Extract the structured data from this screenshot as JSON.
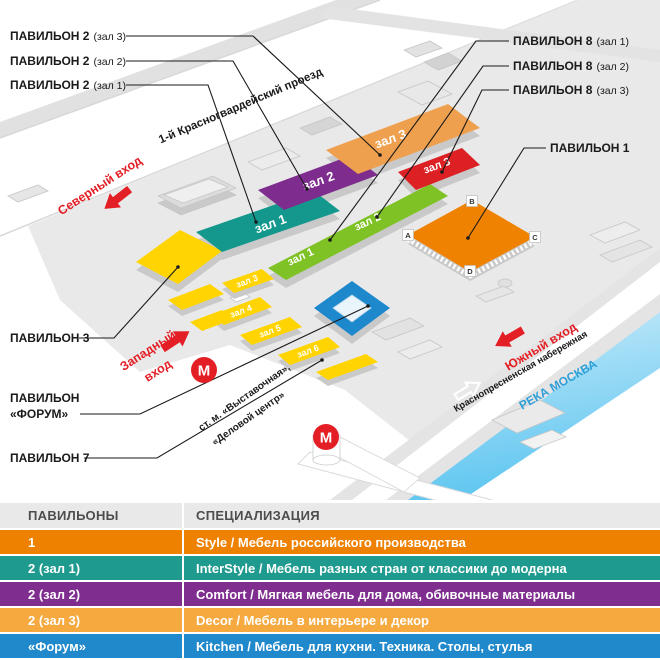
{
  "colors": {
    "red_accent": "#E31E24",
    "yellow": "#FFD400",
    "teal": "#14988D",
    "purple": "#7E2C8E",
    "light_orange": "#EFA04F",
    "green": "#7FC226",
    "red_hall": "#DC2024",
    "orange_p1": "#EF8200",
    "blue_forum": "#1D88CB",
    "river_text": "#2E9FD8"
  },
  "map": {
    "callouts_left": [
      {
        "title": "ПАВИЛЬОН 2",
        "sub": "(зал 3)"
      },
      {
        "title": "ПАВИЛЬОН 2",
        "sub": "(зал 2)"
      },
      {
        "title": "ПАВИЛЬОН 2",
        "sub": "(зал 1)"
      }
    ],
    "callouts_right": [
      {
        "title": "ПАВИЛЬОН 8",
        "sub": "(зал 1)"
      },
      {
        "title": "ПАВИЛЬОН 8",
        "sub": "(зал 2)"
      },
      {
        "title": "ПАВИЛЬОН 8",
        "sub": "(зал 3)"
      }
    ],
    "callout_p1": "ПАВИЛЬОН 1",
    "callout_p3": "ПАВИЛЬОН 3",
    "callout_forum_line1": "ПАВИЛЬОН",
    "callout_forum_line2": "«ФОРУМ»",
    "callout_p7": "ПАВИЛЬОН 7",
    "entrances": {
      "north": "Северный вход",
      "west_line1": "Западный",
      "west_line2": "вход",
      "south": "Южный вход"
    },
    "streets": {
      "top_road": "1-й Красногвардейский проезд",
      "embankment": "Краснопресненская набережная",
      "river": "РЕКА МОСКВА",
      "metro_line1": "ст. м. «Выставочная»,",
      "metro_line2": "«Деловой центр»"
    },
    "metro_letter": "М",
    "halls": {
      "p2_1": "зал 1",
      "p2_2": "зал 2",
      "p2_3": "зал 3",
      "p8_1": "зал 1",
      "p8_2": "зал 2",
      "p8_3": "зал 3",
      "p7_3": "зал 3",
      "p7_4": "зал 4",
      "p7_5": "зал 5",
      "p7_6": "зал 6"
    },
    "p1_corners": [
      "А",
      "В",
      "С",
      "D"
    ]
  },
  "table": {
    "headers": [
      "ПАВИЛЬОНЫ",
      "СПЕЦИАЛИЗАЦИЯ"
    ],
    "rows": [
      {
        "pavilion": "1",
        "specialization": "Style / Мебель российского производства",
        "color": "#EE8100"
      },
      {
        "pavilion": "2 (зал 1)",
        "specialization": "InterStyle / Мебель разных стран от классики до модерна",
        "color": "#1E9A8E"
      },
      {
        "pavilion": "2 (зал 2)",
        "specialization": "Comfort / Мягкая мебель для дома, обивочные материалы",
        "color": "#7F2D8F"
      },
      {
        "pavilion": "2 (зал 3)",
        "specialization": "Decor / Мебель в интерьере и декор",
        "color": "#F5A93F"
      },
      {
        "pavilion": "«Форум»",
        "specialization": "Kitchen / Мебель для кухни. Техника. Столы, стулья",
        "color": "#2089CB"
      }
    ],
    "cutoff_row_color": "#F0D400"
  }
}
